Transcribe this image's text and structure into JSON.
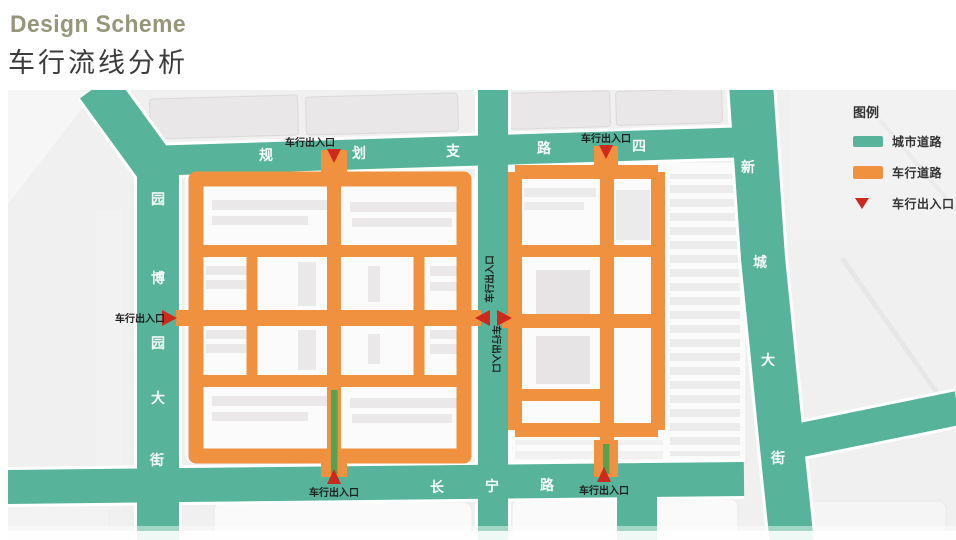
{
  "header": {
    "eyebrow": "Design Scheme",
    "title": "车行流线分析"
  },
  "legend": {
    "title": "图例",
    "items": [
      {
        "id": "city-road",
        "label": "城市道路",
        "color": "#57b49a"
      },
      {
        "id": "vehicle-road",
        "label": "车行道路",
        "color": "#f0913f"
      },
      {
        "id": "vehicle-entrance",
        "label": "车行出入口",
        "color": "#cb2a1d"
      }
    ]
  },
  "map": {
    "colors": {
      "city_road": "#57b49a",
      "vehicle_road": "#f0913f",
      "entrance_marker": "#cb2a1d",
      "median_green": "#55a351",
      "road_label": "#ffffff"
    },
    "entrance_label": "车行出入口",
    "entrance_points": [
      "left-block-north",
      "right-block-north",
      "left-block-west",
      "left-block-east",
      "right-block-west",
      "left-block-south",
      "right-block-south"
    ],
    "roads": {
      "top": {
        "name": "规划支路四",
        "chars": [
          "规",
          "划",
          "支",
          "路",
          "四"
        ]
      },
      "left": {
        "name": "园博园大街",
        "chars": [
          "园",
          "博",
          "园",
          "大",
          "街"
        ]
      },
      "right": {
        "name": "新城大街",
        "chars": [
          "新",
          "城",
          "大",
          "街"
        ]
      },
      "bottom": {
        "name": "长宁路",
        "chars": [
          "长",
          "宁",
          "路"
        ]
      }
    }
  }
}
